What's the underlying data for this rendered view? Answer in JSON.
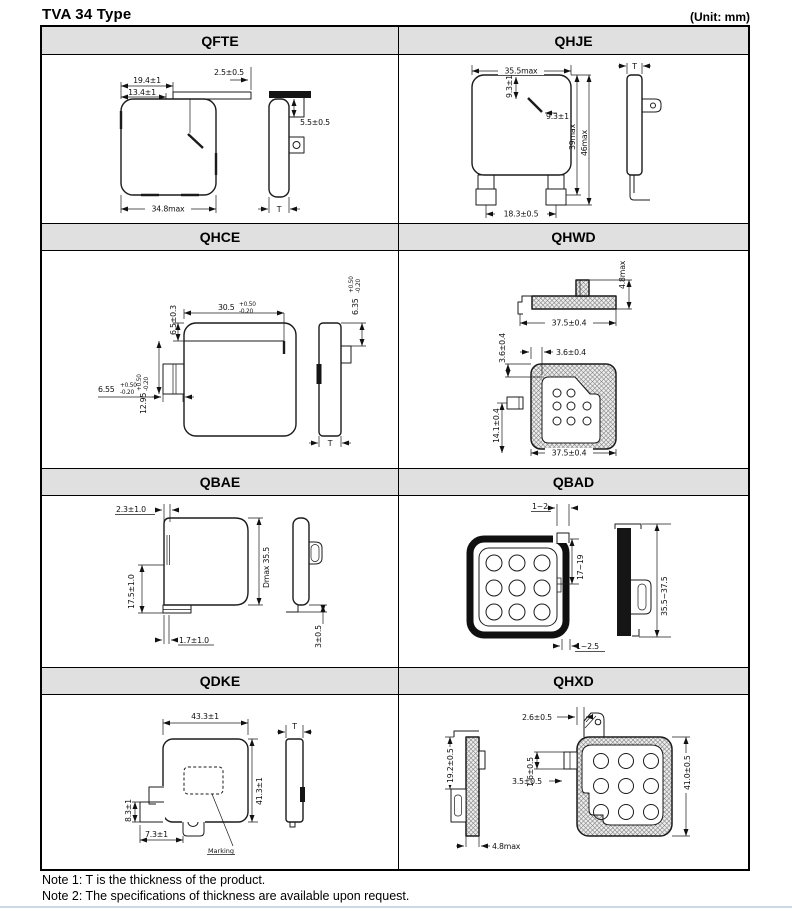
{
  "header": {
    "title": "TVA 34 Type",
    "unit": "(Unit: mm)"
  },
  "panels": [
    {
      "id": "QFTE",
      "title": "QFTE",
      "dims": {
        "a": "19.4±1",
        "b": "13.4±1",
        "c": "2.5±0.5",
        "d": "5.5±0.5",
        "e": "34.8max",
        "t": "T"
      }
    },
    {
      "id": "QHJE",
      "title": "QHJE",
      "dims": {
        "a": "35.5max",
        "b": "9.3±1",
        "c": "9.3±1",
        "d": "39max",
        "e": "46max",
        "f": "18.3±0.5",
        "t": "T"
      }
    },
    {
      "id": "QHCE",
      "title": "QHCE",
      "dims": {
        "a": {
          "v": "30.5",
          "p": "+0.50",
          "m": "-0.20"
        },
        "b": "6.5±0.3",
        "c": {
          "v": "6.55",
          "p": "+0.50",
          "m": "-0.20"
        },
        "d": {
          "v": "12.95",
          "p": "+0.50",
          "m": "-0.20"
        },
        "e": {
          "v": "6.35",
          "p": "+0.50",
          "m": "-0.20"
        },
        "t": "T"
      }
    },
    {
      "id": "QHWD",
      "title": "QHWD",
      "dims": {
        "a": "4.8max",
        "b": "37.5±0.4",
        "c": "3.6±0.4",
        "d": "3.6±0.4",
        "e": "14.1±0.4",
        "f": "37.5±0.4"
      }
    },
    {
      "id": "QBAE",
      "title": "QBAE",
      "dims": {
        "a": "2.3±1.0",
        "b": "Dmax 35.5",
        "c": "17.5±1.0",
        "d": "1.7±1.0",
        "e": "3±0.5"
      }
    },
    {
      "id": "QBAD",
      "title": "QBAD",
      "dims": {
        "a": "1~2",
        "b": "17~19",
        "c": "1~2.5",
        "d": "35.5~37.5"
      }
    },
    {
      "id": "QDKE",
      "title": "QDKE",
      "dims": {
        "a": "43.3±1",
        "b": "41.3±1",
        "c": "8.3±1",
        "d": "7.3±1",
        "t": "T",
        "marking": "Marking"
      }
    },
    {
      "id": "QHXD",
      "title": "QHXD",
      "dims": {
        "a": "19.2±0.5",
        "b": "2.6±0.5",
        "c": "1.6±0.5",
        "d": "3.5±0.5",
        "e": "41.0±0.5",
        "f": "4.8max"
      }
    }
  ],
  "notes": {
    "n1": "Note 1: T is the thickness of the product.",
    "n2": "Note 2: The specifications of thickness are available upon request."
  }
}
